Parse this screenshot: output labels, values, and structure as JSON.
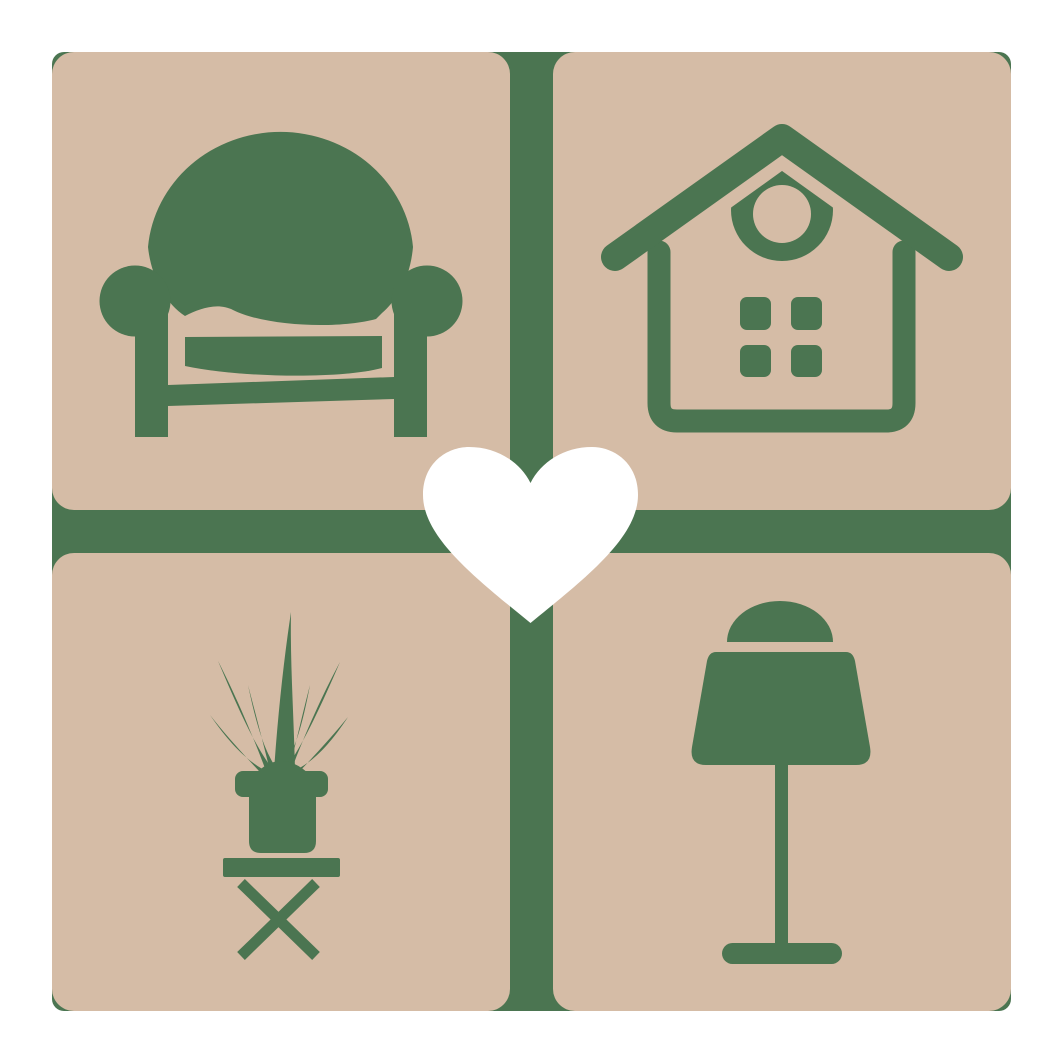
{
  "colors": {
    "page": "#ffffff",
    "green": "#4b7551",
    "tan": "#d5bca6",
    "heart": "#ffffff"
  },
  "logo": {
    "backplate": {
      "shape": "rounded-square",
      "color_ref": "green"
    },
    "tiles": [
      {
        "position": "top-left",
        "icon": "armchair-icon",
        "subject": "armchair"
      },
      {
        "position": "top-right",
        "icon": "house-icon",
        "subject": "house with ring ornament and four windows"
      },
      {
        "position": "bottom-left",
        "icon": "potted-plant-icon",
        "subject": "spiky potted plant on cross-leg stool"
      },
      {
        "position": "bottom-right",
        "icon": "table-lamp-icon",
        "subject": "table lamp"
      }
    ],
    "center_icon": "heart-icon"
  }
}
